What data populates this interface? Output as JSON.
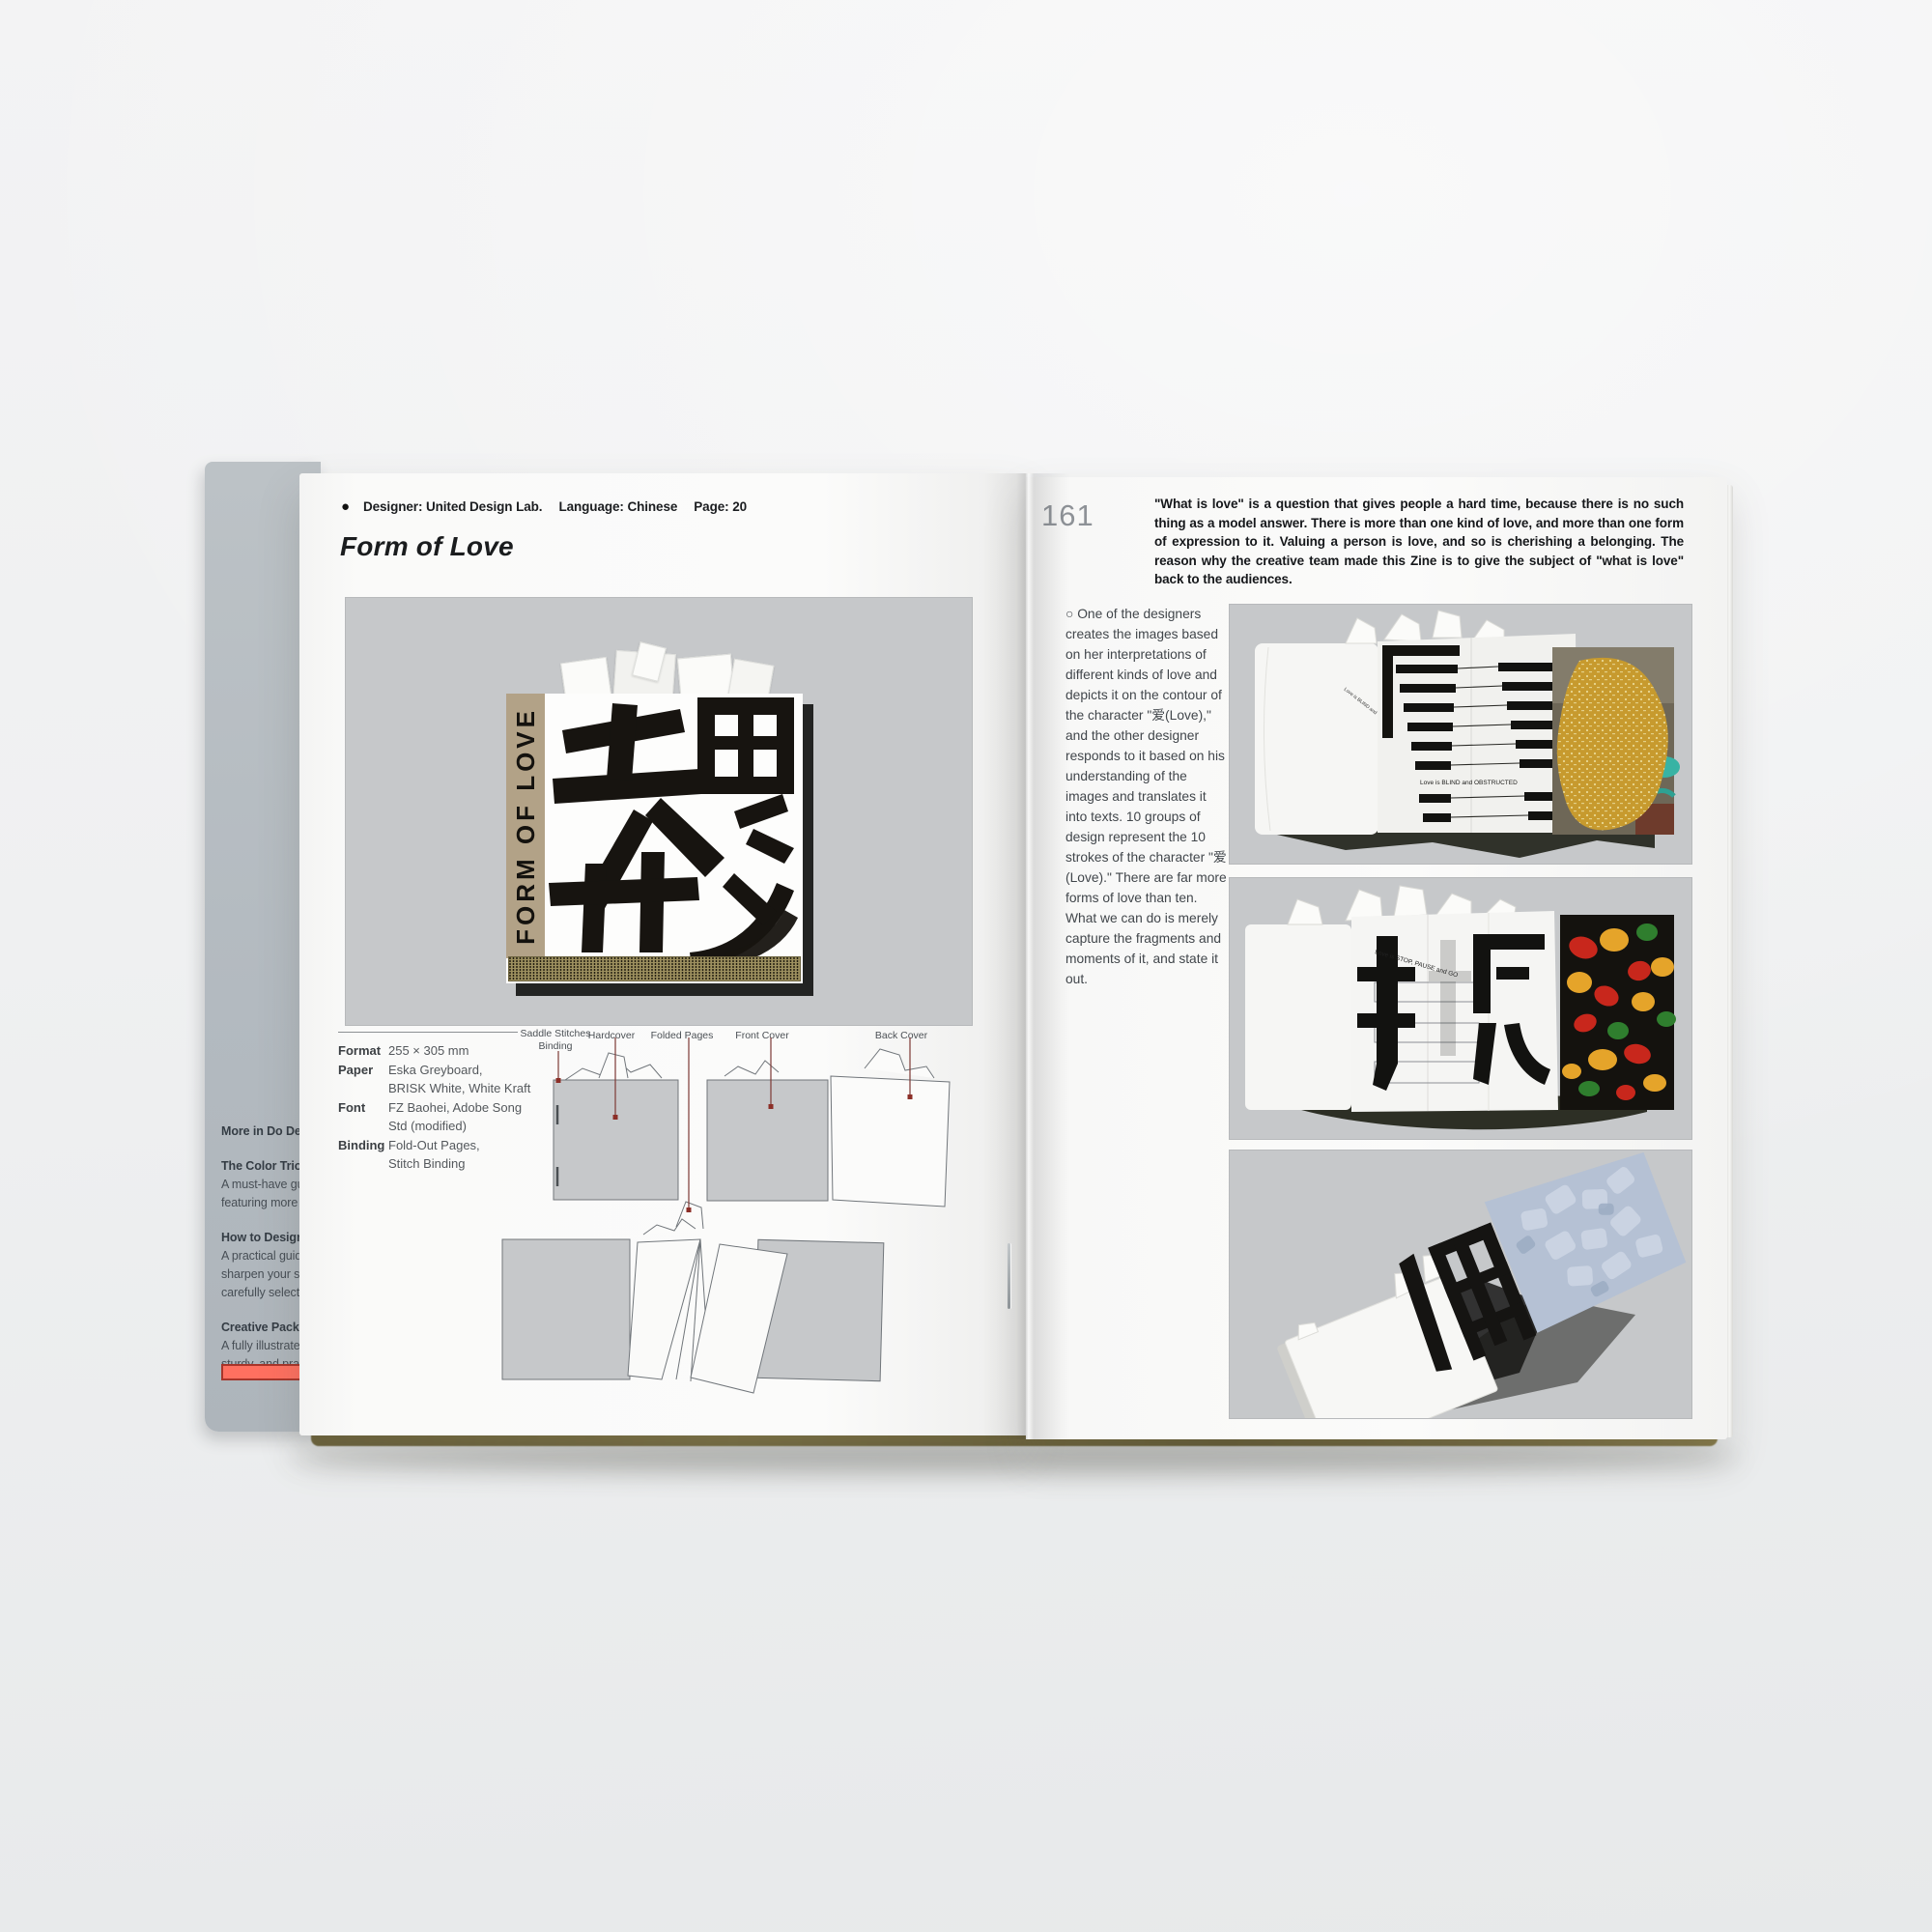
{
  "meta": {
    "page_left_number": "160",
    "page_right_number": "161"
  },
  "header": {
    "bullet": "●",
    "designer": "Designer: United Design Lab.",
    "language": "Language: Chinese",
    "page": "Page: 20"
  },
  "left_page": {
    "title": "Form of Love",
    "cover": {
      "vertical_title": "FORM OF LOVE"
    },
    "specs": [
      {
        "label": "Format",
        "value": "255 × 305 mm"
      },
      {
        "label": "Paper",
        "value": "Eska Greyboard,\nBRISK White, White Kraft"
      },
      {
        "label": "Font",
        "value": "FZ Baohei, Adobe Song\nStd (modified)"
      },
      {
        "label": "Binding",
        "value": "Fold-Out Pages,\nStitch Binding"
      }
    ],
    "diagram_labels": {
      "saddle_line1": "Saddle Stitches",
      "saddle_line2": "Binding",
      "hardcover": "Hardcover",
      "folded": "Folded Pages",
      "front": "Front Cover",
      "back": "Back Cover"
    }
  },
  "right_page": {
    "intro": "\"What is love\" is a question that gives people a hard time, because there is no such thing as a model answer. There is more than one kind of love, and more than one form of expression to it. Valuing a person is love, and so is cherishing a belonging. The reason why the creative team made this Zine is to give the subject of \"what is love\" back to the audiences.",
    "column_marker": "○",
    "column": "One of the designers creates the images based on her interpretations of different kinds of love and depicts it on the contour of the character \"爱(Love),\" and the other designer responds to it based on his understanding of the images and translates it into texts. 10 groups of design represent the 10 strokes of the character \"爱(Love).\" There are far more forms of love than ten. What we can do is merely capture the fragments and moments of it, and state it out.",
    "photo1_caption": "Love is BLIND and OBSTRUCTED",
    "photo2_caption": "Love is STOP, PAUSE and GO"
  },
  "undercover": {
    "heading": "More in Do Desi",
    "e1_title": "The Color Trio: F",
    "e1_l1": "A must-have gui",
    "e1_l2": "featuring more t",
    "e2_title": "How to Design a",
    "e2_l1": "A practical guide",
    "e2_l2": "sharpen your sk",
    "e2_l3": "carefully selecte",
    "e3_title": "Creative Packag",
    "e3_l1": "A fully illustrated",
    "e3_l2": "sturdy, and prac"
  },
  "colors": {
    "panel_grey": "#c6c8ca",
    "accent_red": "#ff7060",
    "kraft": "#b2a287",
    "gold": "#c79a2e",
    "fruit_red": "#c8271c",
    "fruit_yellow": "#e5a42a",
    "fruit_green": "#2f7e2e",
    "blue_page": "#b5c1d4"
  }
}
